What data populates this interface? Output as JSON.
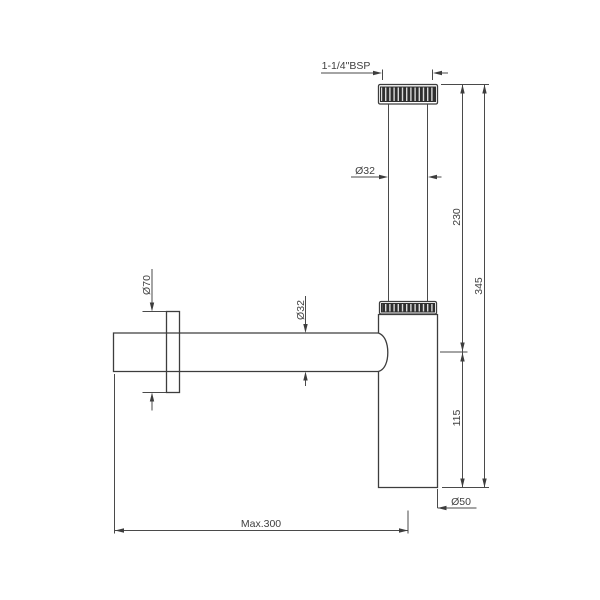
{
  "drawing": {
    "type": "technical-dimension-drawing",
    "subject": "bottle-trap-siphon",
    "background_color": "#ffffff",
    "line_color": "#3d3d3d",
    "text_color": "#3f3f3f",
    "knurl_color": "#2f2f2f",
    "labels": {
      "thread_size": "1-1/4\"BSP",
      "tailpiece_diameter": "Ø32",
      "tailpiece_length": "230",
      "overall_height": "345",
      "waste_pipe_diameter": "Ø32",
      "flange_diameter": "Ø70",
      "body_height": "115",
      "body_diameter": "Ø50",
      "max_horizontal_reach": "Max.300"
    }
  }
}
